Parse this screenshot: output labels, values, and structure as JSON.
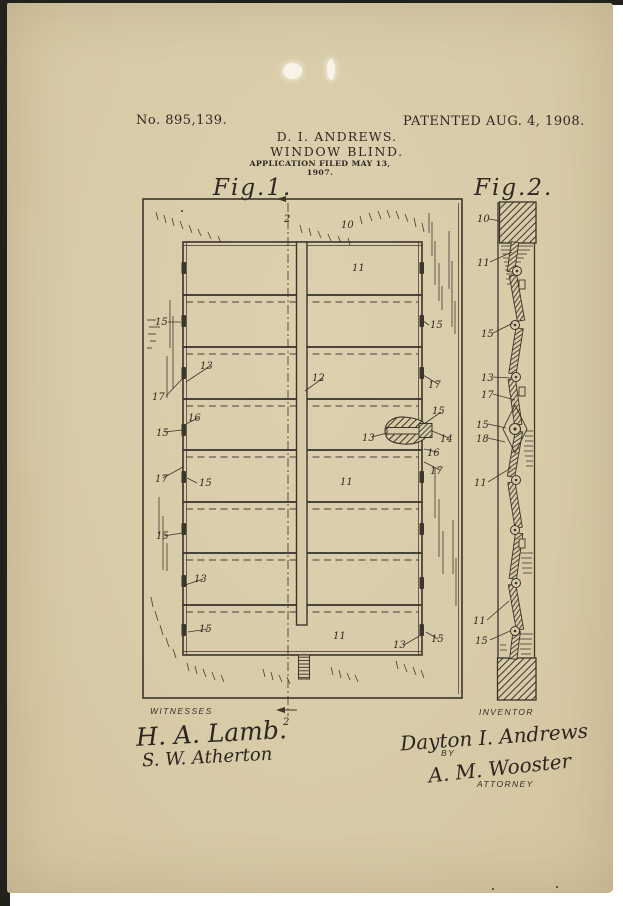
{
  "header": {
    "patent_number": "No. 895,139.",
    "patented": "PATENTED AUG. 4, 1908.",
    "inventor_line": "D. I. ANDREWS.",
    "title_line": "WINDOW BLIND.",
    "application_line": "APPLICATION FILED MAY 13, 1907."
  },
  "figures": {
    "fig1": {
      "label": "Fig.1.",
      "ref_labels": [
        {
          "t": "2",
          "x": 284,
          "y": 222
        },
        {
          "t": "10",
          "x": 341,
          "y": 228
        },
        {
          "t": "11",
          "x": 352,
          "y": 271
        },
        {
          "t": "15",
          "x": 155,
          "y": 325
        },
        {
          "t": "15",
          "x": 430,
          "y": 328
        },
        {
          "t": "13",
          "x": 200,
          "y": 369
        },
        {
          "t": "12",
          "x": 312,
          "y": 381
        },
        {
          "t": "17",
          "x": 428,
          "y": 388
        },
        {
          "t": "17",
          "x": 152,
          "y": 400
        },
        {
          "t": "15",
          "x": 432,
          "y": 414
        },
        {
          "t": "16",
          "x": 188,
          "y": 421
        },
        {
          "t": "15",
          "x": 156,
          "y": 436
        },
        {
          "t": "13",
          "x": 362,
          "y": 441
        },
        {
          "t": "14",
          "x": 440,
          "y": 442
        },
        {
          "t": "16",
          "x": 427,
          "y": 456
        },
        {
          "t": "17",
          "x": 430,
          "y": 474
        },
        {
          "t": "17",
          "x": 155,
          "y": 482
        },
        {
          "t": "15",
          "x": 199,
          "y": 486
        },
        {
          "t": "11",
          "x": 340,
          "y": 485
        },
        {
          "t": "15",
          "x": 156,
          "y": 539
        },
        {
          "t": "13",
          "x": 194,
          "y": 582
        },
        {
          "t": "15",
          "x": 199,
          "y": 632
        },
        {
          "t": "11",
          "x": 333,
          "y": 639
        },
        {
          "t": "13",
          "x": 393,
          "y": 648
        },
        {
          "t": "15",
          "x": 431,
          "y": 642
        },
        {
          "t": "2",
          "x": 283,
          "y": 725
        }
      ]
    },
    "fig2": {
      "label": "Fig.2.",
      "ref_labels": [
        {
          "t": "10",
          "x": 477,
          "y": 222
        },
        {
          "t": "11",
          "x": 477,
          "y": 266
        },
        {
          "t": "15",
          "x": 481,
          "y": 337
        },
        {
          "t": "13",
          "x": 481,
          "y": 381
        },
        {
          "t": "17",
          "x": 481,
          "y": 398
        },
        {
          "t": "15",
          "x": 476,
          "y": 428
        },
        {
          "t": "18",
          "x": 476,
          "y": 442
        },
        {
          "t": "11",
          "x": 474,
          "y": 486
        },
        {
          "t": "11",
          "x": 473,
          "y": 624
        },
        {
          "t": "15",
          "x": 475,
          "y": 644
        }
      ]
    }
  },
  "footer": {
    "witnesses_heading": "WITNESSES",
    "witness_1": "H. A. Lamb.",
    "witness_2": "S. W. Atherton",
    "inventor_heading": "INVENTOR",
    "inventor_signature": "Dayton I. Andrews",
    "by_label": "BY",
    "attorney_signature": "A. M. Wooster",
    "attorney_heading": "ATTORNEY"
  },
  "colors": {
    "paper": "#d8cba8",
    "ink": "#2d2822",
    "line": "#3b352b"
  }
}
